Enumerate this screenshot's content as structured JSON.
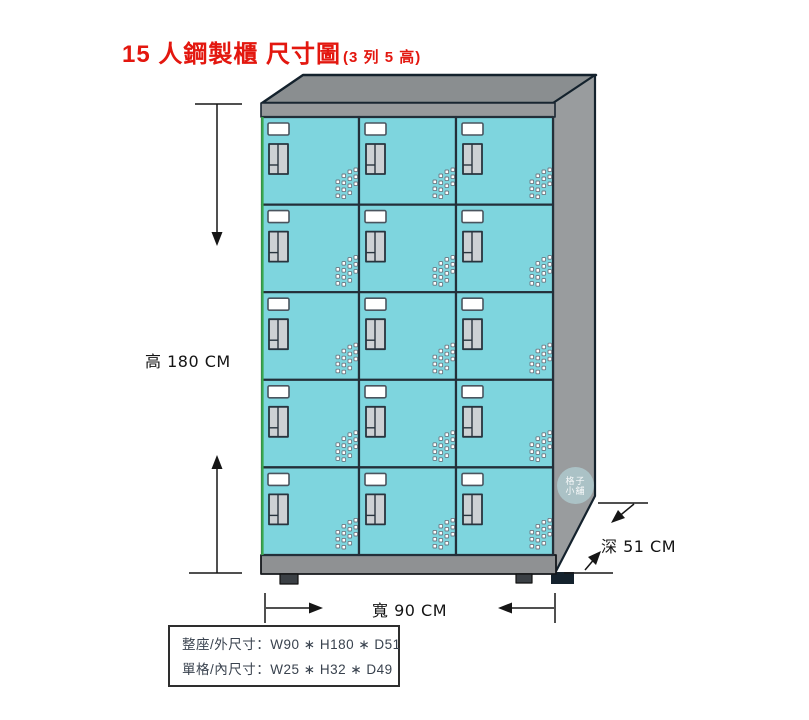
{
  "title": {
    "main": "15 人鋼製櫃 尺寸圖",
    "suffix": "(3 列 5 高)",
    "color": "#e3170f"
  },
  "dimensions": {
    "height": {
      "label": "高 180 CM"
    },
    "width": {
      "label": "寬 90 CM"
    },
    "depth": {
      "label": "深 51 CM"
    }
  },
  "info_box": {
    "lines": [
      "整座/外尺寸：W90 ∗ H180 ∗ D51",
      "單格/內尺寸：W25 ∗ H32 ∗ D49"
    ]
  },
  "watermark": {
    "line1": "格子",
    "line2": "小舖"
  },
  "cabinet": {
    "columns": 3,
    "rows": 5,
    "total_compartments": 15,
    "colors": {
      "door": "#7ed5de",
      "door_border": "#232f39",
      "left_edge_highlight": "#3aa94f",
      "top_face": "#8a8e90",
      "side_panel": "#999c9e",
      "front_rail": "#97999b",
      "base": "#8f9193",
      "foot": "#3b4045",
      "plate": "#ffffff",
      "plate_border": "#4a545e",
      "handle": "#cdd1d4",
      "handle_border": "#28343e",
      "vent_fill": "#ffffff",
      "vent_border": "#6a7680",
      "outline": "#14222d",
      "dimension_line": "#161616"
    }
  }
}
